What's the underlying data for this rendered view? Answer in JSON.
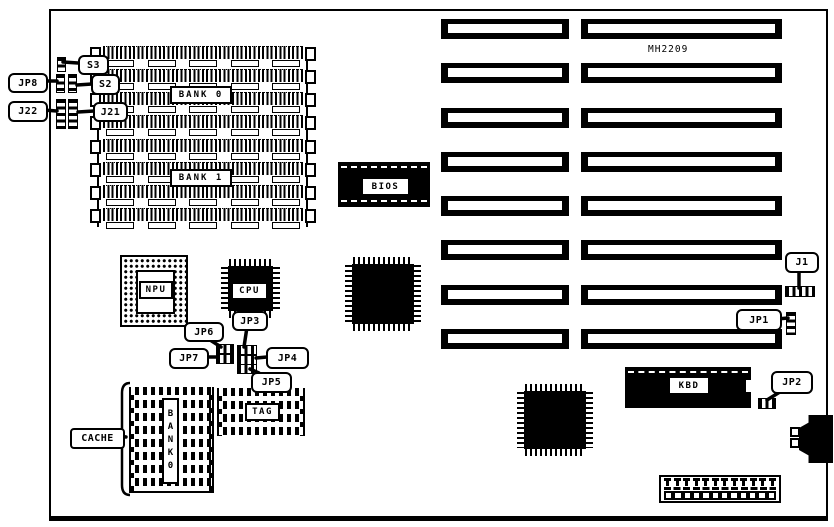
{
  "board": {
    "model": "MH2209",
    "ink": "#000000",
    "paper": "#ffffff"
  },
  "memory": {
    "bank0_label": "BANK 0",
    "bank1_label": "BANK 1",
    "cache_label": "CACHE",
    "cache_bank_label": "BANK0",
    "tag_label": "TAG"
  },
  "chips": {
    "bios": "BIOS",
    "cpu": "CPU",
    "npu": "NPU",
    "kbd": "KBD"
  },
  "jumpers": {
    "s3": "S3",
    "s2": "S2",
    "jp8": "JP8",
    "j21": "J21",
    "j22": "J22",
    "jp3": "JP3",
    "jp4": "JP4",
    "jp5": "JP5",
    "jp6": "JP6",
    "jp7": "JP7",
    "j1": "J1",
    "jp1": "JP1",
    "jp2": "JP2"
  },
  "counts": {
    "simm_rows": 8,
    "simm_body_boxes": 5,
    "isa_left_slots": 8,
    "isa_right_slots": 8,
    "cache_rows": 8,
    "tag_rows": 4,
    "power_pins": 12,
    "power_sockets": 12
  }
}
